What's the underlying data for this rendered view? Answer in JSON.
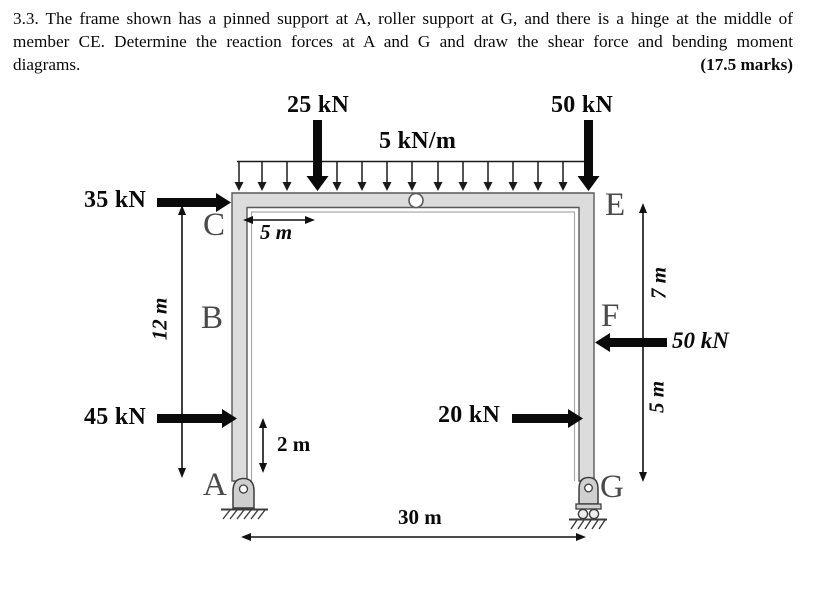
{
  "problem": {
    "line1": "3.3. The frame shown has a pinned support at A, roller support at G, and there is a hinge at the middle of",
    "line2": "member CE. Determine the reaction forces at A and G and draw the shear force and bending moment",
    "line3": "diagrams.",
    "marks": "(17.5 marks)"
  },
  "diagram": {
    "nodes": {
      "a": "A",
      "b": "B",
      "c": "C",
      "e": "E",
      "f": "F",
      "g": "G"
    },
    "loads": {
      "point_top_left": "25 kN",
      "point_top_right": "50 kN",
      "distributed": "5 kN/m",
      "side_c": "35 kN",
      "side_a": "45 kN",
      "side_g": "20 kN",
      "side_f": "50 kN"
    },
    "dimensions": {
      "beam_offset": "5 m",
      "left_height": "12 m",
      "a_offset": "2 m",
      "span": "30 m",
      "ef": "7 m",
      "fg": "5 m"
    },
    "colors": {
      "member_fill": "#dcdcdc",
      "member_stroke": "#585858",
      "node_label": "#4a4a4a",
      "ink": "#0a0a0a"
    }
  }
}
